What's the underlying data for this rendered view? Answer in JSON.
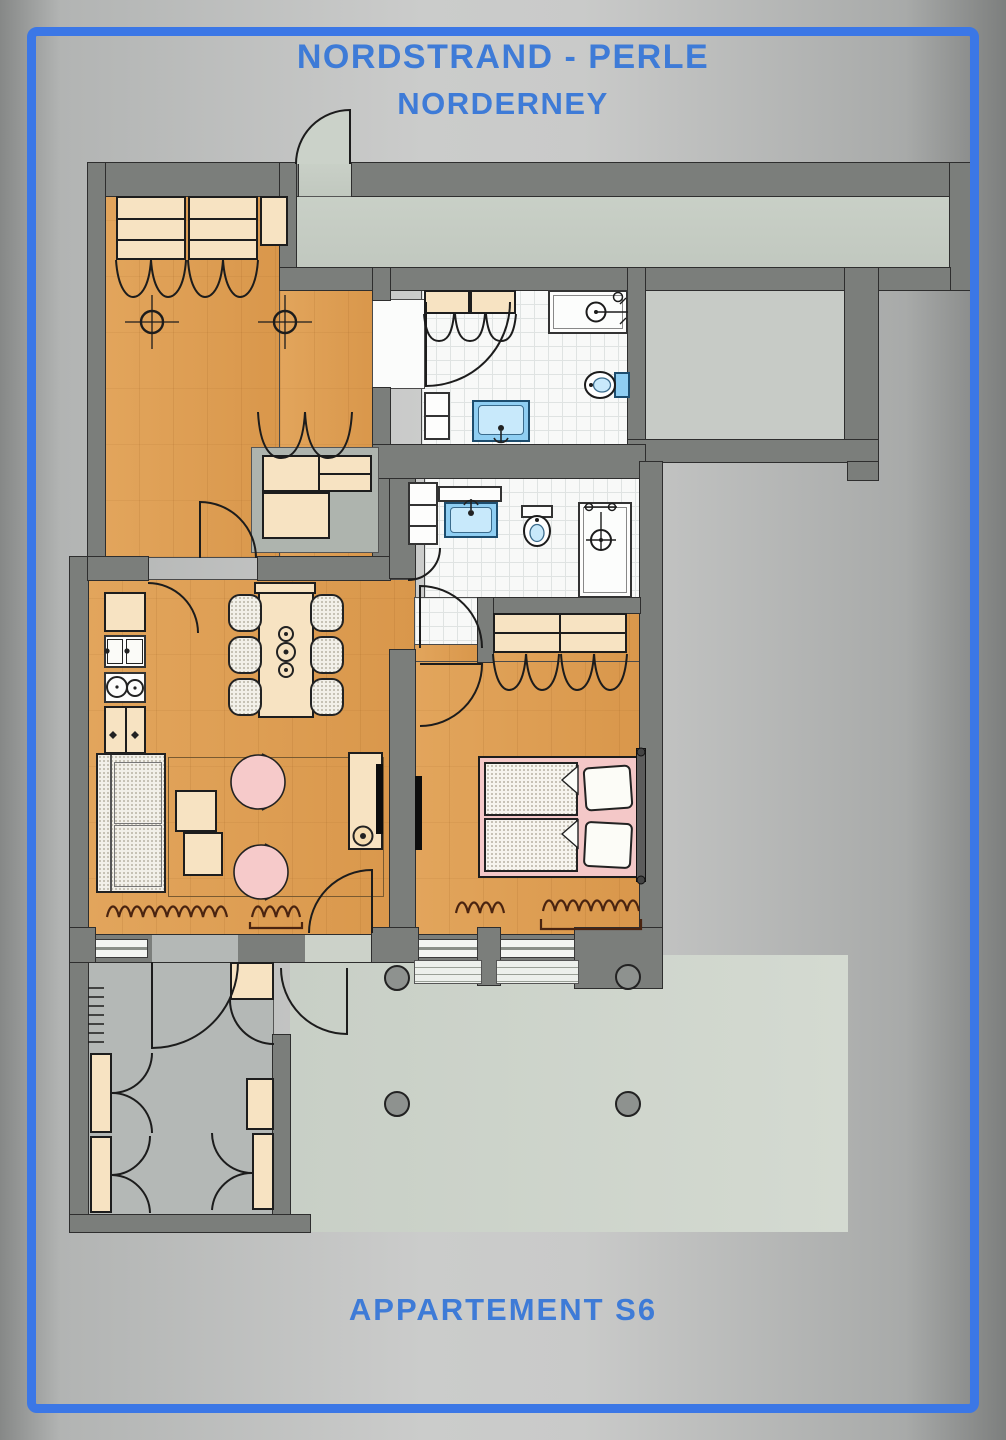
{
  "header": {
    "line1": "NORDSTRAND - PERLE",
    "line2": "NORDERNEY"
  },
  "footer": {
    "label": "APPARTEMENT S6"
  },
  "palette": {
    "frame_blue": "#3b77e6",
    "title_blue": "#3e7bd7",
    "wall_gray": "#7b7e7b",
    "wood_floor": "#dfa057",
    "tile_floor": "#f8f9f8",
    "corridor_floor": "#c6cdc4",
    "hall_floor": "#b4b8b6",
    "terrace_floor": "#cdd3ca",
    "furniture_tan": "#f5dcb0",
    "fixture_blue": "#8fcef2",
    "armchair_pink": "#f6caca",
    "bed_pink": "#f4c8c8"
  }
}
